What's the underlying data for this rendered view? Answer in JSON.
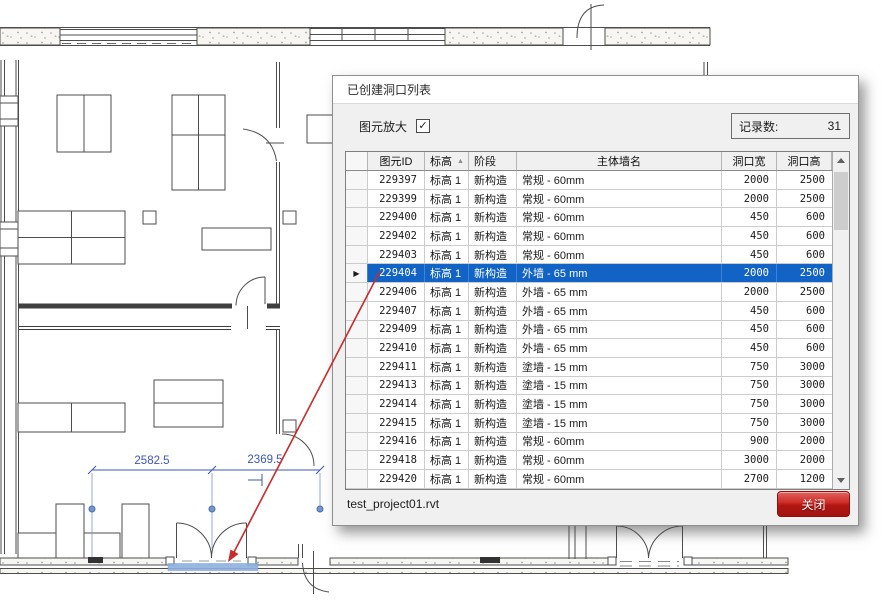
{
  "dialog": {
    "title": "已创建洞口列表",
    "zoom_checkbox": {
      "label": "图元放大",
      "checked": true,
      "check_glyph": "✓"
    },
    "record_count": {
      "label": "记录数:",
      "value": "31"
    },
    "file_name": "test_project01.rvt",
    "close_button_label": "关闭",
    "table": {
      "columns": [
        "图元ID",
        "标高",
        "阶段",
        "主体墙名",
        "洞口宽",
        "洞口高"
      ],
      "sorted_column_index": 1,
      "sort_asc_icon": "▲",
      "row_marker_icon": "▶",
      "selected_index": 5,
      "rows": [
        [
          "229397",
          "标高 1",
          "新构造",
          "常规 - 60mm",
          "2000",
          "2500"
        ],
        [
          "229399",
          "标高 1",
          "新构造",
          "常规 - 60mm",
          "2000",
          "2500"
        ],
        [
          "229400",
          "标高 1",
          "新构造",
          "常规 - 60mm",
          "450",
          "600"
        ],
        [
          "229402",
          "标高 1",
          "新构造",
          "常规 - 60mm",
          "450",
          "600"
        ],
        [
          "229403",
          "标高 1",
          "新构造",
          "常规 - 60mm",
          "450",
          "600"
        ],
        [
          "229404",
          "标高 1",
          "新构造",
          "外墙 - 65 mm",
          "2000",
          "2500"
        ],
        [
          "229406",
          "标高 1",
          "新构造",
          "外墙 - 65 mm",
          "2000",
          "2500"
        ],
        [
          "229407",
          "标高 1",
          "新构造",
          "外墙 - 65 mm",
          "450",
          "600"
        ],
        [
          "229409",
          "标高 1",
          "新构造",
          "外墙 - 65 mm",
          "450",
          "600"
        ],
        [
          "229410",
          "标高 1",
          "新构造",
          "外墙 - 65 mm",
          "450",
          "600"
        ],
        [
          "229411",
          "标高 1",
          "新构造",
          "塗墙 - 15 mm",
          "750",
          "3000"
        ],
        [
          "229413",
          "标高 1",
          "新构造",
          "塗墙 - 15 mm",
          "750",
          "3000"
        ],
        [
          "229414",
          "标高 1",
          "新构造",
          "塗墙 - 15 mm",
          "750",
          "3000"
        ],
        [
          "229415",
          "标高 1",
          "新构造",
          "塗墙 - 15 mm",
          "750",
          "3000"
        ],
        [
          "229416",
          "标高 1",
          "新构造",
          "常规 - 60mm",
          "900",
          "2000"
        ],
        [
          "229418",
          "标高 1",
          "新构造",
          "常规 - 60mm",
          "3000",
          "2000"
        ],
        [
          "229420",
          "标高 1",
          "新构造",
          "常规 - 60mm",
          "2700",
          "1200"
        ]
      ]
    }
  },
  "plan": {
    "dimension_left": "2582.5",
    "dimension_right": "2369.5"
  },
  "colors": {
    "selection_blue": "#1263c6",
    "dimension_blue": "#3b55bd",
    "leader_red": "#cc2a2a",
    "opening_highlight": "#8fb0e0",
    "close_button_red": "#b01713"
  }
}
